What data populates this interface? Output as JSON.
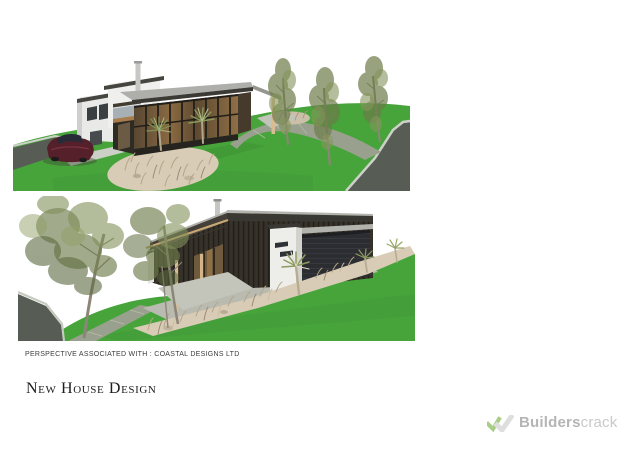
{
  "document": {
    "caption": "PERSPECTIVE ASSOCIATED WITH : COASTAL DESIGNS LTD",
    "title": "New House Design"
  },
  "renders": {
    "top_alt": "Street-side perspective render: two-storey house with glazed living pavilion, car on driveway, tussock garden, cabbage trees, three street trees and curving road",
    "bottom_alt": "Entry courtyard perspective render: timber pergola, white entry tower, garage with dark door, diagonal tussock garden bed, cabbage trees, two large trees and road"
  },
  "watermark": {
    "brand_bold": "Builders",
    "brand_light": "crack"
  },
  "colors": {
    "page_bg": "#ffffff",
    "lawn": "#47a43b",
    "road": "#575c55",
    "curb": "#cdd1c9",
    "path": "#99a08d",
    "courtyard": "#b9bbb0",
    "cladding_dark": "#322e27",
    "wall_white": "#ededea",
    "roof_gray": "#b3b3ae",
    "fascia_dark": "#3a3833",
    "timber_post": "#d8bd92",
    "glass_interior": "#8a6a42",
    "grass_bed": "#d8ccb7",
    "tree_olive": "#6f7e4c",
    "car_red": "#56202a",
    "caption_text": "#3c3c3c",
    "title_text": "#1d1d1d",
    "logo_green": "#a9cd87",
    "logo_gray": "#dedede",
    "logo_text_bold": "#b5b5b5",
    "logo_text_light": "#c9c9c9"
  }
}
